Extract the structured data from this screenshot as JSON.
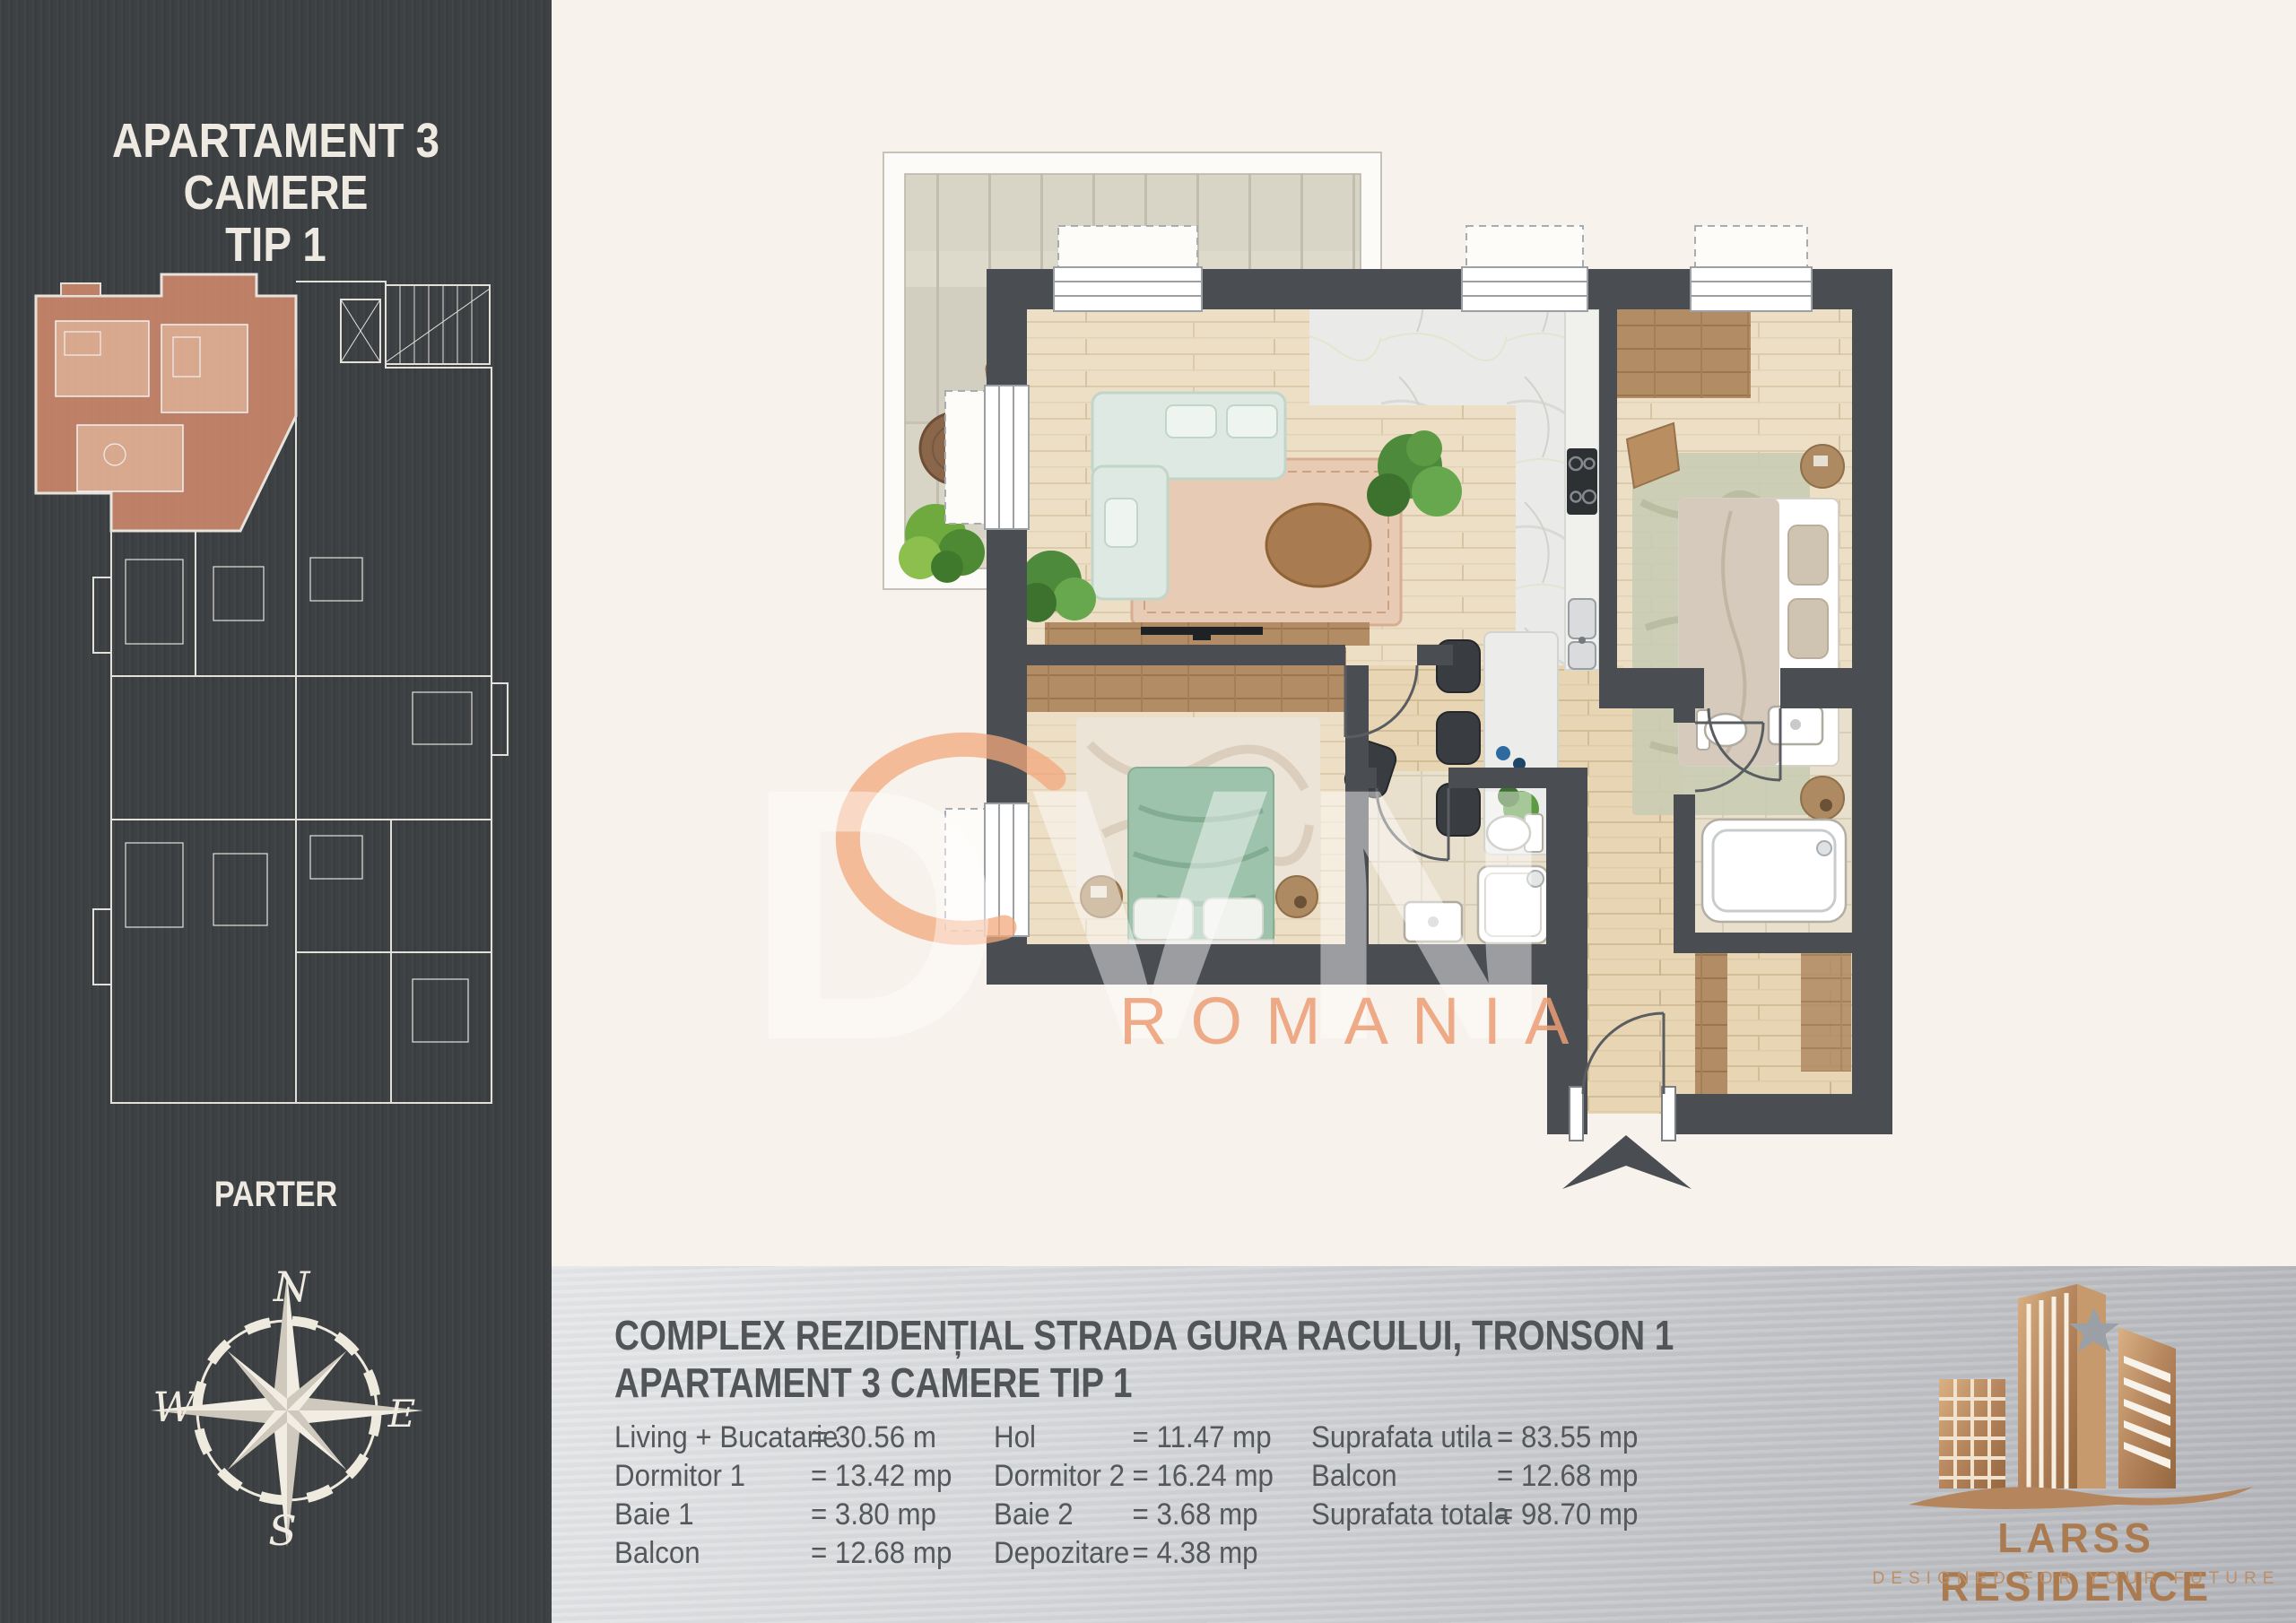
{
  "sidebar": {
    "title_line1": "APARTAMENT 3 CAMERE",
    "title_line2": "TIP 1",
    "floor_label": "PARTER",
    "compass": {
      "north": "N",
      "east": "E",
      "south": "S",
      "west": "W"
    }
  },
  "watermark": {
    "brand": "DVN",
    "country": "ROMANIA"
  },
  "footer": {
    "project_line1": "COMPLEX REZIDENȚIAL STRADA GURA RACULUI, TRONSON 1",
    "project_line2": "APARTAMENT 3 CAMERE TIP 1",
    "columns": [
      {
        "rows": [
          {
            "label": "Living + Bucatarie",
            "value": "= 30.56 m"
          },
          {
            "label": "Dormitor 1",
            "value": "= 13.42 mp"
          },
          {
            "label": "Baie 1",
            "value": "=  3.80 mp"
          },
          {
            "label": "Balcon",
            "value": "= 12.68 mp"
          }
        ]
      },
      {
        "rows": [
          {
            "label": "Hol",
            "value": "= 11.47 mp"
          },
          {
            "label": "Dormitor 2",
            "value": "= 16.24 mp"
          },
          {
            "label": "Baie 2",
            "value": "=  3.68 mp"
          },
          {
            "label": "Depozitare",
            "value": "= 4.38 mp"
          }
        ]
      },
      {
        "rows": [
          {
            "label": "Suprafata utila",
            "value": "= 83.55 mp"
          },
          {
            "label": "Balcon",
            "value": "= 12.68 mp"
          },
          {
            "label": "Suprafata totala",
            "value": "= 98.70 mp"
          }
        ]
      }
    ]
  },
  "logo": {
    "name": "LARSS RESIDENCE",
    "tagline": "DESIGNED FOR YOUR FUTURE"
  },
  "colors": {
    "sidebar": "#3d4144",
    "cream": "#f7f2eb",
    "wall": "#4a4e52",
    "accent_salmon": "#c9866a",
    "watermark_orange": "#f0a47a",
    "logo_bronze": "#b5855d",
    "mint_sofa": "#dde9e2",
    "green_bed": "#9dc3ac"
  }
}
